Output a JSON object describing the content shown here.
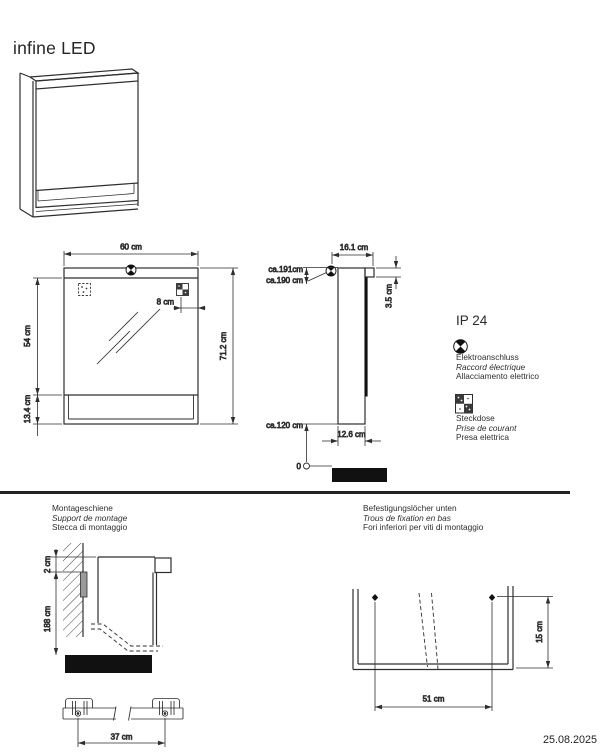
{
  "page": {
    "title": "infine LED",
    "date": "25.08.2025"
  },
  "legend": {
    "ip_rating": "IP 24",
    "electro_lines": [
      "Elektroanschluss",
      "Raccord électrique",
      "Allacciamento elettrico"
    ],
    "socket_lines": [
      "Steckdose",
      "Prise de courant",
      "Presa elettrica"
    ],
    "icons": {
      "electro": "quartered-circle-icon",
      "socket": "socket-schematic-icon"
    }
  },
  "front_view": {
    "dim_width": "60 cm",
    "dim_socket_offset": "8 cm",
    "dim_mirror_height": "54 cm",
    "dim_shelf_height": "13.4 cm",
    "dim_total_height": "71.2 cm"
  },
  "side_view": {
    "dim_depth": "16.1 cm",
    "dim_light_height": "3.5 cm",
    "dim_height_top": "ca.191cm",
    "dim_height_connection": "ca.190 cm",
    "dim_height_bottom": "ca.120 cm",
    "dim_body_depth": "12.6 cm",
    "zero_label": "0"
  },
  "mounting_rail": {
    "title_lines": [
      "Montageschiene",
      "Support de montage",
      "Stecca di montaggio"
    ],
    "dim_top_offset": "2 cm",
    "dim_height": "188 cm",
    "dim_bracket_spacing": "37 cm"
  },
  "fixation_holes": {
    "title_lines": [
      "Befestigungslöcher unten",
      "Trous de fixation en bas",
      "Fori inferiori per viti di montaggio"
    ],
    "dim_hole_spacing": "51 cm",
    "dim_hole_height": "15 cm"
  }
}
